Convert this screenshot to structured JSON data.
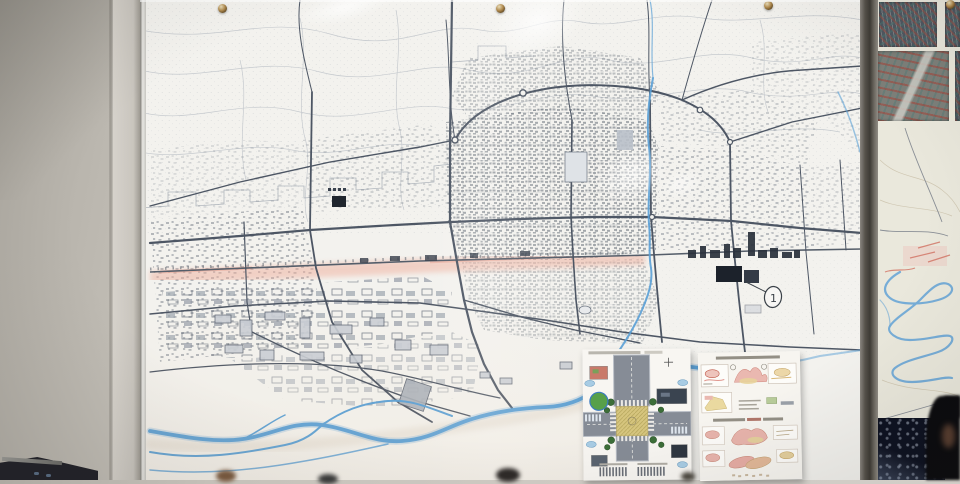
{
  "scene": {
    "type": "photograph",
    "subject": "wall-mounted city master plan map behind glass with pinned design posters"
  },
  "map": {
    "annotation_circled_number": "1",
    "screw_count": 4,
    "colors": {
      "paper": "#f3f2ee",
      "road_ink": "#4d5664",
      "contour": "#a9b0ba",
      "river": "#5aa0d6",
      "railway_band": "#efae9b",
      "dark_building": "#1c222b",
      "plaza_block": "#dfe3e7"
    }
  },
  "posters": {
    "left_plan": {
      "content": "intersection square landscape plan",
      "road_color": "#868c96",
      "plaza_color": "#d6c57e",
      "tree_color": "#3c6e38",
      "callout_color": "#a8cce4"
    },
    "right_sheet": {
      "content": "annotated sketch diagrams sheet",
      "sketch_pink": "#e8b4ac",
      "sketch_tan": "#e4cf9c",
      "sketch_red": "#c05a4a"
    }
  },
  "right_panel": {
    "aerial_photo_count": 4,
    "river_color": "#6aa6d6",
    "night_image_color": "#0d1120",
    "paper_color": "#eae8dc"
  },
  "environment": {
    "wall_color": "#c6c2ba",
    "frame_color": "#56524b"
  }
}
